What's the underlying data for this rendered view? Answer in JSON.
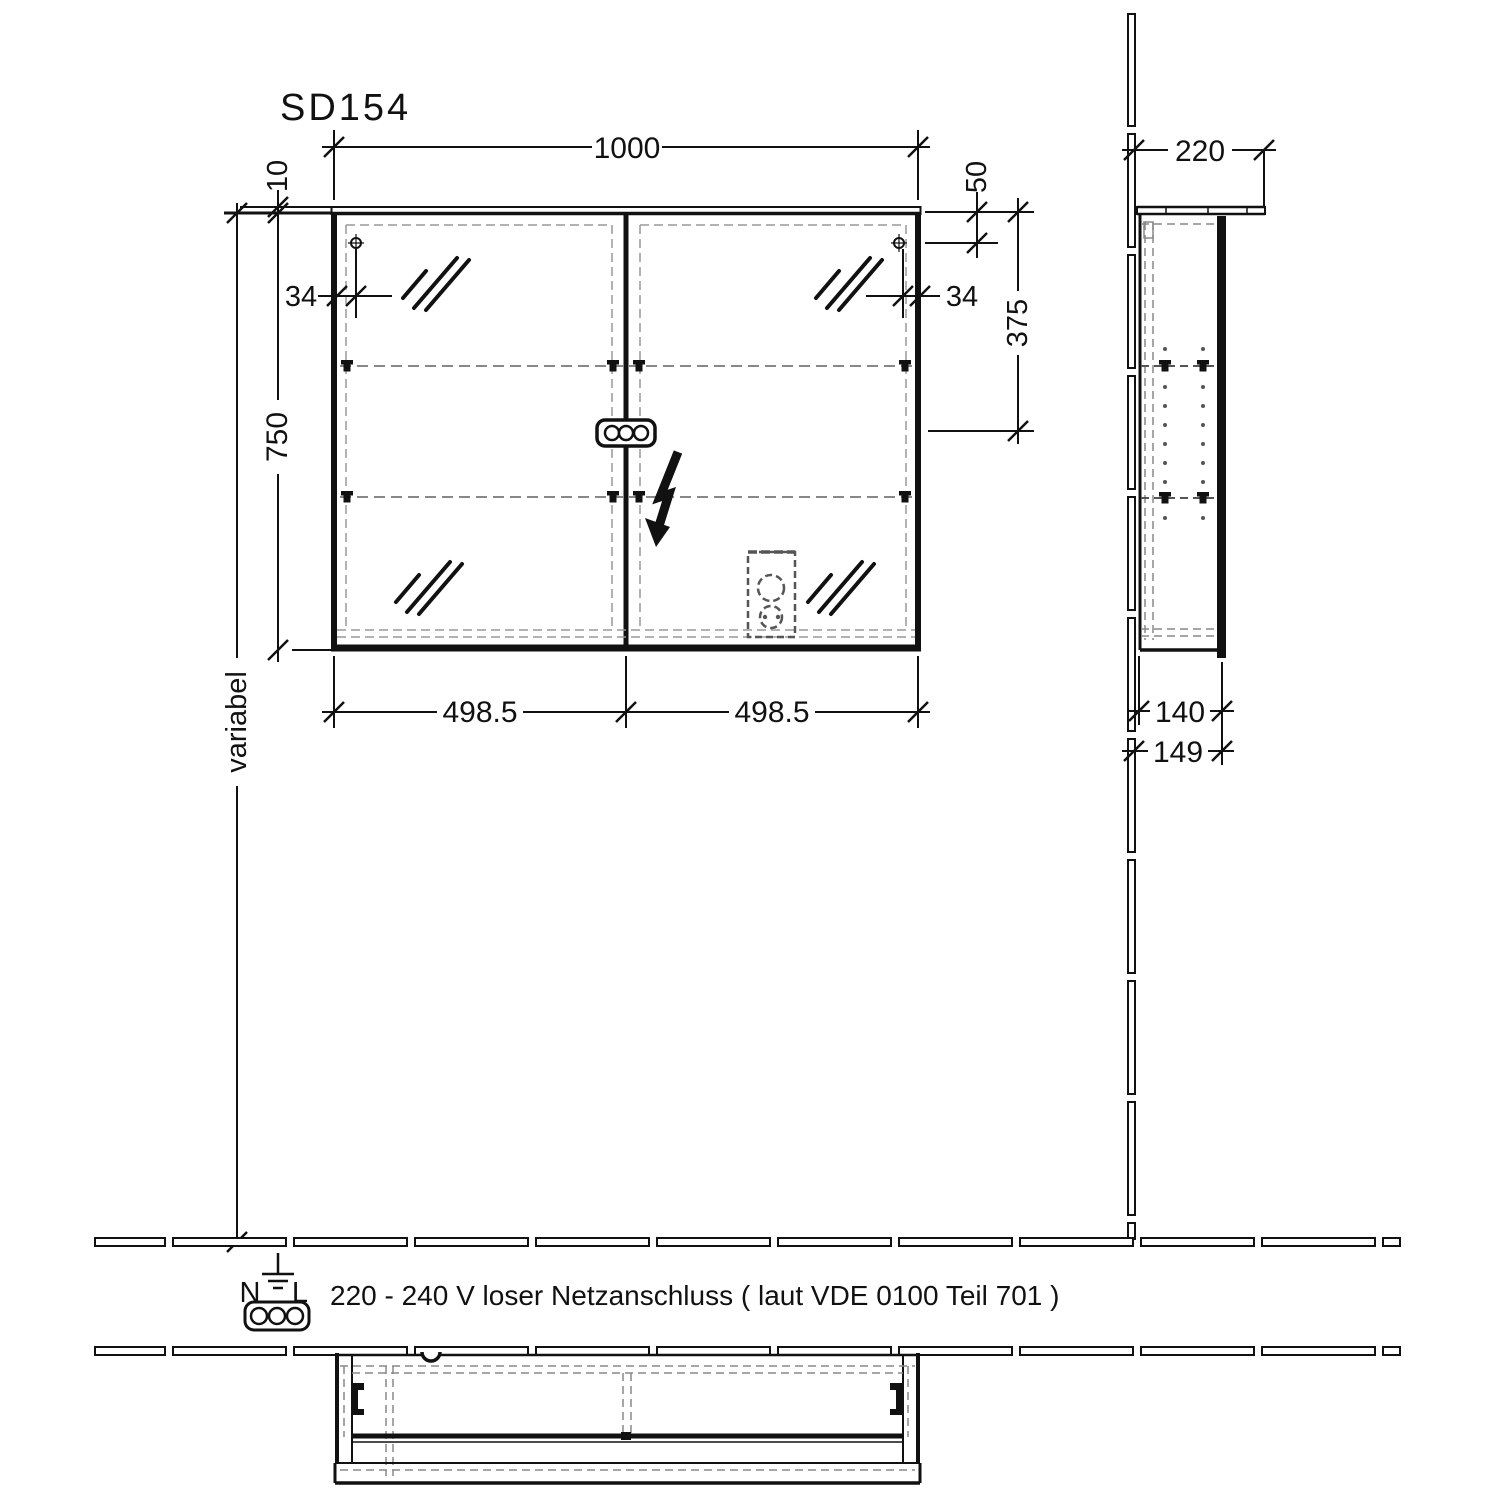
{
  "title": "SD154",
  "front_view": {
    "dim_width": "1000",
    "dim_top_panel_thickness": "10",
    "dim_hinge_inset_left": "34",
    "dim_hinge_inset_right": "34",
    "dim_height": "750",
    "dim_top_to_fixing": "50",
    "dim_top_to_center": "375",
    "dim_door_width_left": "498.5",
    "dim_door_width_right": "498.5",
    "dim_mounting_height": "variabel"
  },
  "side_view": {
    "dim_depth_overall": "220",
    "dim_body_depth": "140",
    "dim_depth_with_door": "149"
  },
  "power_note": {
    "terminal_n": "N",
    "terminal_l": "L",
    "text": "220 - 240 V loser Netzanschluss ( laut VDE 0100 Teil 701 )"
  }
}
